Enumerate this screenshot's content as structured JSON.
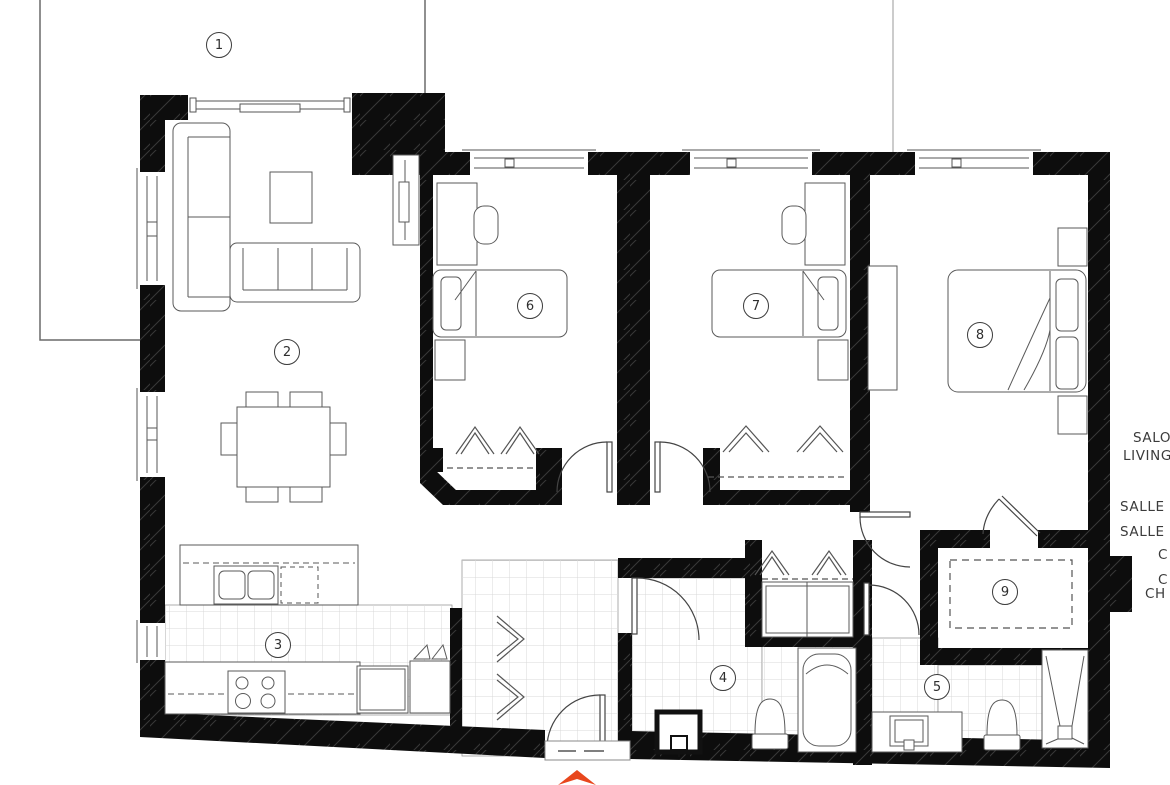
{
  "plan": {
    "rooms": [
      {
        "number": "1",
        "name": "terrace"
      },
      {
        "number": "2",
        "name": "living-room"
      },
      {
        "number": "3",
        "name": "kitchen"
      },
      {
        "number": "4",
        "name": "bathroom"
      },
      {
        "number": "5",
        "name": "bathroom-2"
      },
      {
        "number": "6",
        "name": "bedroom"
      },
      {
        "number": "7",
        "name": "bedroom-2"
      },
      {
        "number": "8",
        "name": "bedroom-3"
      },
      {
        "number": "9",
        "name": "walk-in-closet"
      }
    ],
    "legend_lines": [
      "SALO",
      "LIVING R",
      "SALLE",
      "SALLE",
      "C",
      "C",
      "CH"
    ],
    "colors": {
      "entrance_arrow": "#E8471D",
      "walls": "#0d0d0d",
      "tile_line": "#d9d9d9"
    }
  }
}
